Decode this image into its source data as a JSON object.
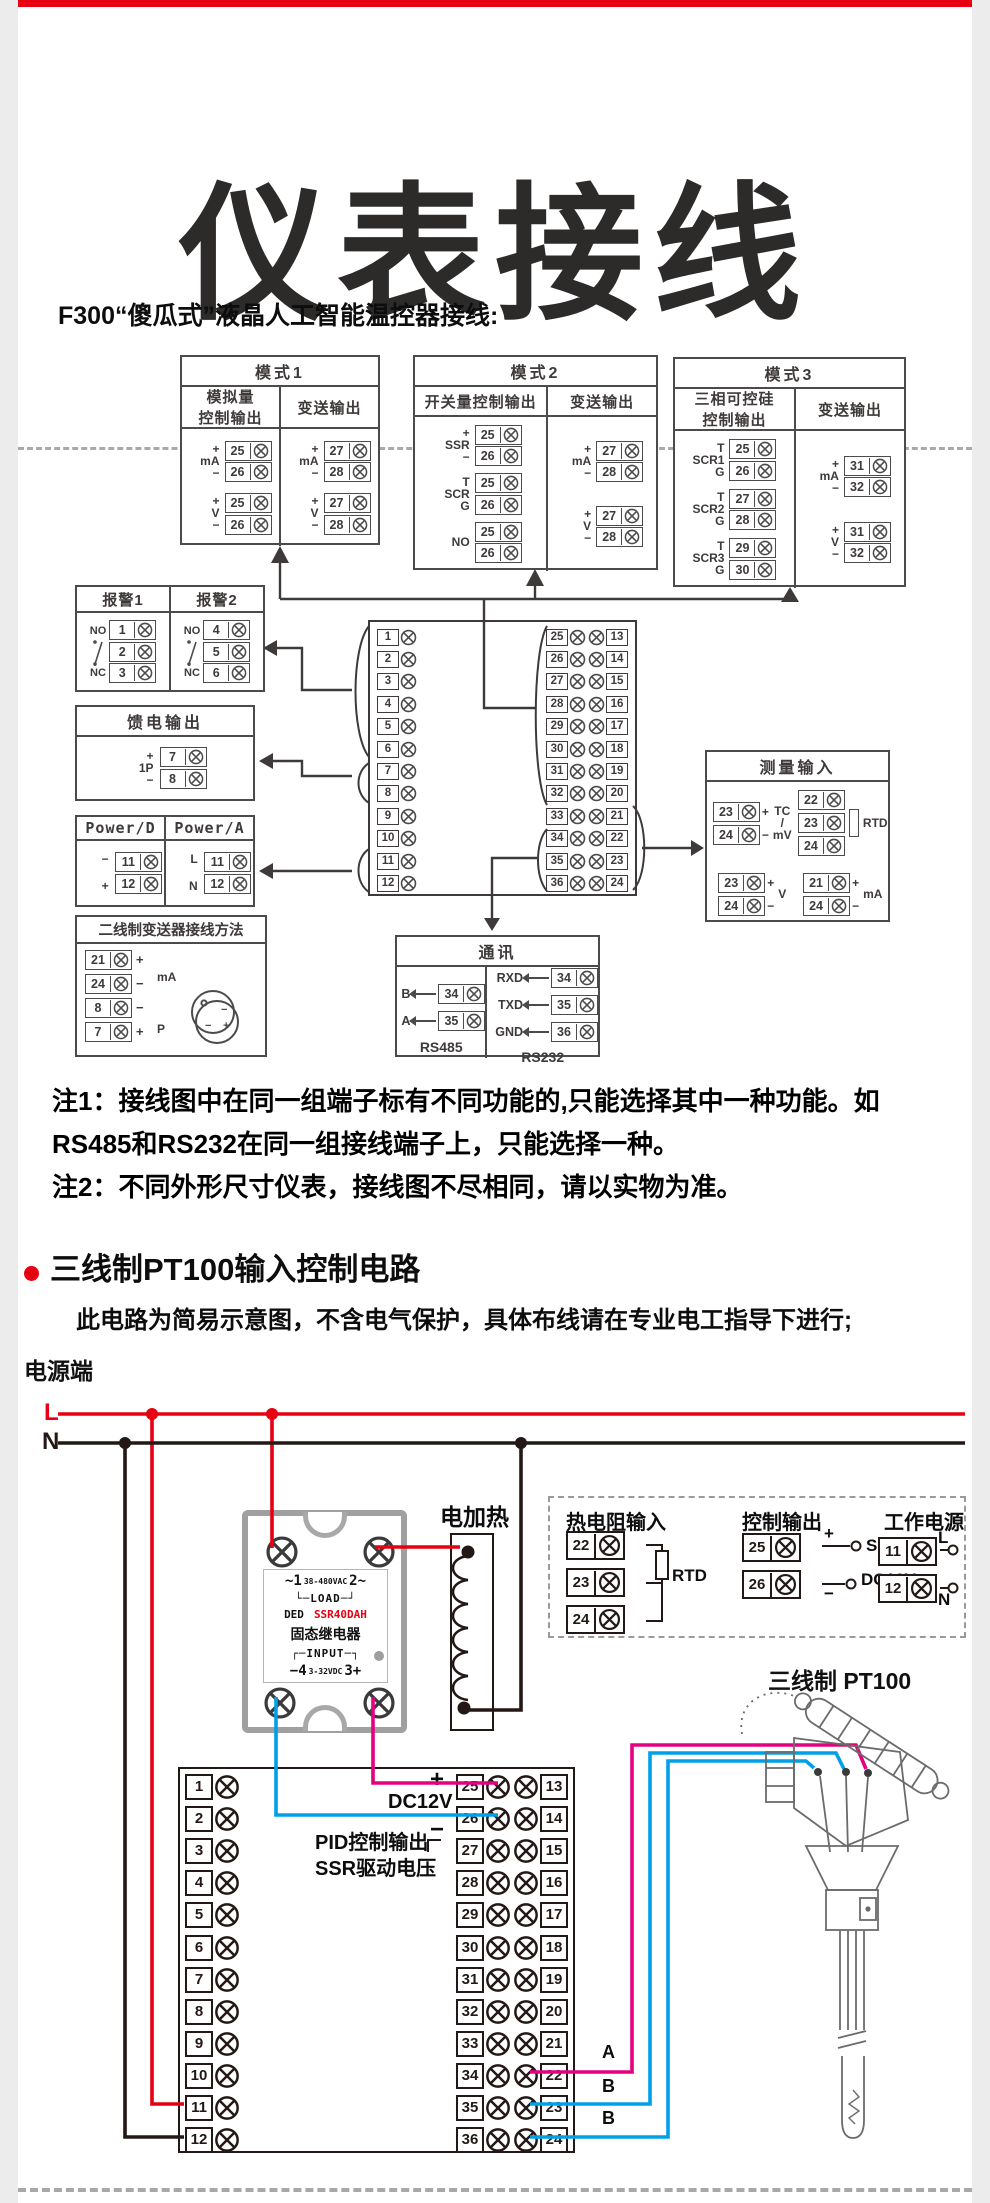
{
  "page": {
    "title": "仪表接线",
    "intro": "F300“傻瓜式”液晶人工智能温控器接线:",
    "notes": "注1：接线图中在同一组端子标有不同功能的,只能选择其中一种功能。如\nRS485和RS232在同一组接线端子上，只能选择一种。\n注2：不同外形尺寸仪表，接线图不尽相同，请以实物为准。"
  },
  "colors": {
    "accent_red": "#e60012",
    "wire_blue": "#00a0e9",
    "wire_magenta": "#e4007f",
    "line_dark": "#3e3a39",
    "line_black": "#231815"
  },
  "mode1": {
    "title": "模式1",
    "col1": {
      "title": "模拟量\n控制输出",
      "groups": [
        {
          "top": "+",
          "label": "mA",
          "bot": "−",
          "t1": "25",
          "t2": "26"
        },
        {
          "top": "+",
          "label": "V",
          "bot": "−",
          "t1": "25",
          "t2": "26"
        }
      ]
    },
    "col2": {
      "title": "变送输出",
      "groups": [
        {
          "top": "+",
          "label": "mA",
          "bot": "−",
          "t1": "27",
          "t2": "28"
        },
        {
          "top": "+",
          "label": "V",
          "bot": "−",
          "t1": "27",
          "t2": "28"
        }
      ]
    }
  },
  "mode2": {
    "title": "模式2",
    "col1": {
      "title": "开关量控制输出",
      "groups": [
        {
          "top": "+",
          "label": "SSR",
          "bot": "−",
          "t1": "25",
          "t2": "26"
        },
        {
          "top": "T",
          "label": "SCR",
          "bot": "G",
          "t1": "25",
          "t2": "26"
        },
        {
          "top": "",
          "label": "NO",
          "bot": "",
          "t1": "25",
          "t2": "26"
        }
      ]
    },
    "col2": {
      "title": "变送输出",
      "groups": [
        {
          "top": "+",
          "label": "mA",
          "bot": "−",
          "t1": "27",
          "t2": "28"
        },
        {
          "top": "+",
          "label": "V",
          "bot": "−",
          "t1": "27",
          "t2": "28"
        }
      ]
    }
  },
  "mode3": {
    "title": "模式3",
    "col1": {
      "title": "三相可控硅\n控制输出",
      "groups": [
        {
          "top": "T",
          "label": "SCR1",
          "bot": "G",
          "t1": "25",
          "t2": "26"
        },
        {
          "top": "T",
          "label": "SCR2",
          "bot": "G",
          "t1": "27",
          "t2": "28"
        },
        {
          "top": "T",
          "label": "SCR3",
          "bot": "G",
          "t1": "29",
          "t2": "30"
        }
      ]
    },
    "col2": {
      "title": "变送输出",
      "groups": [
        {
          "top": "+",
          "label": "mA",
          "bot": "−",
          "t1": "31",
          "t2": "32"
        },
        {
          "top": "+",
          "label": "V",
          "bot": "−",
          "t1": "31",
          "t2": "32"
        }
      ]
    }
  },
  "alarm": {
    "cols": [
      {
        "title": "报警1",
        "no": "NO",
        "nc": "NC",
        "t1": "1",
        "t2": "2",
        "t3": "3"
      },
      {
        "title": "报警2",
        "no": "NO",
        "nc": "NC",
        "t1": "4",
        "t2": "5",
        "t3": "6"
      }
    ]
  },
  "feed": {
    "title": "馈电输出",
    "label": "1P",
    "plus": "+",
    "minus": "−",
    "t1": "7",
    "t2": "8"
  },
  "power": {
    "d": {
      "title": "Power/D",
      "m1": "−",
      "m2": "+",
      "t1": "11",
      "t2": "12"
    },
    "a": {
      "title": "Power/A",
      "m1": "L",
      "m2": "N",
      "t1": "11",
      "t2": "12"
    }
  },
  "twowire": {
    "title": "二线制变送器接线方法",
    "rows": [
      {
        "n": "21",
        "m": "+"
      },
      {
        "n": "24",
        "m": "−"
      },
      {
        "n": "8",
        "m": "−"
      },
      {
        "n": "7",
        "m": "+"
      }
    ],
    "label1": "mA",
    "label2": "P",
    "tx1": "−",
    "tx2": "−",
    "tx3": "+"
  },
  "blocks": {
    "left": [
      "1",
      "2",
      "3",
      "4",
      "5",
      "6",
      "7",
      "8",
      "9",
      "10",
      "11",
      "12"
    ],
    "right": [
      {
        "a": "25",
        "b": "13"
      },
      {
        "a": "26",
        "b": "14"
      },
      {
        "a": "27",
        "b": "15"
      },
      {
        "a": "28",
        "b": "16"
      },
      {
        "a": "29",
        "b": "17"
      },
      {
        "a": "30",
        "b": "18"
      },
      {
        "a": "31",
        "b": "19"
      },
      {
        "a": "32",
        "b": "20"
      },
      {
        "a": "33",
        "b": "21"
      },
      {
        "a": "34",
        "b": "22"
      },
      {
        "a": "35",
        "b": "23"
      },
      {
        "a": "36",
        "b": "24"
      }
    ]
  },
  "meas": {
    "title": "测量输入",
    "tc": {
      "t1": "23",
      "t2": "24",
      "plus": "+",
      "minus": "−",
      "label": "TC\n/\nmV"
    },
    "rtd": {
      "t1": "22",
      "t2": "23",
      "t3": "24",
      "label": "RTD"
    },
    "v": {
      "t1": "23",
      "t2": "24",
      "plus": "+",
      "minus": "−",
      "label": "V"
    },
    "ma": {
      "t1": "21",
      "t2": "24",
      "plus": "+",
      "minus": "−",
      "label": "mA"
    }
  },
  "comm": {
    "title": "通讯",
    "rs485": {
      "rows": [
        {
          "p": "B",
          "n": "34"
        },
        {
          "p": "A",
          "n": "35"
        }
      ],
      "foot": "RS485"
    },
    "rs232": {
      "rows": [
        {
          "p": "RXD",
          "n": "34"
        },
        {
          "p": "TXD",
          "n": "35"
        },
        {
          "p": "GND",
          "n": "36"
        }
      ],
      "foot": "RS232"
    }
  },
  "section2": {
    "title": "三线制PT100输入控制电路",
    "subtitle": "此电路为简易示意图，不含电气保护，具体布线请在专业电工指导下进行;"
  },
  "rail": {
    "label": "电源端",
    "l": "L",
    "n": "N"
  },
  "ssr": {
    "l1a": "~1",
    "l1b": "38-480VAC",
    "l1c": "2~",
    "l2": "└─LOAD─┘",
    "l3a": "DED",
    "l3b": "SSR40DAH",
    "l4": "固态继电器",
    "l5": "┌─INPUT─┐",
    "l6a": "−4",
    "l6b": "3-32VDC",
    "l6c": "3+"
  },
  "heater": {
    "label": "电加热"
  },
  "dashbox": {
    "rtd": {
      "title": "热电阻输入",
      "t1": "22",
      "t2": "23",
      "t3": "24",
      "label": "RTD"
    },
    "ctrl": {
      "title": "控制输出",
      "t1": "25",
      "t2": "26",
      "plus": "+",
      "minus": "−",
      "l1": "SSR",
      "l2": "DC12V"
    },
    "pwr": {
      "title": "工作电源",
      "t1": "11",
      "t2": "12",
      "l": "L",
      "n": "N"
    }
  },
  "bottom": {
    "plus": "+",
    "dc12v": "DC12V",
    "minus": "−",
    "pid1": "PID控制输出",
    "pid2": "SSR驱动电压",
    "a": "A",
    "b1": "B",
    "b2": "B"
  },
  "sensor": {
    "label": "三线制 PT100"
  }
}
